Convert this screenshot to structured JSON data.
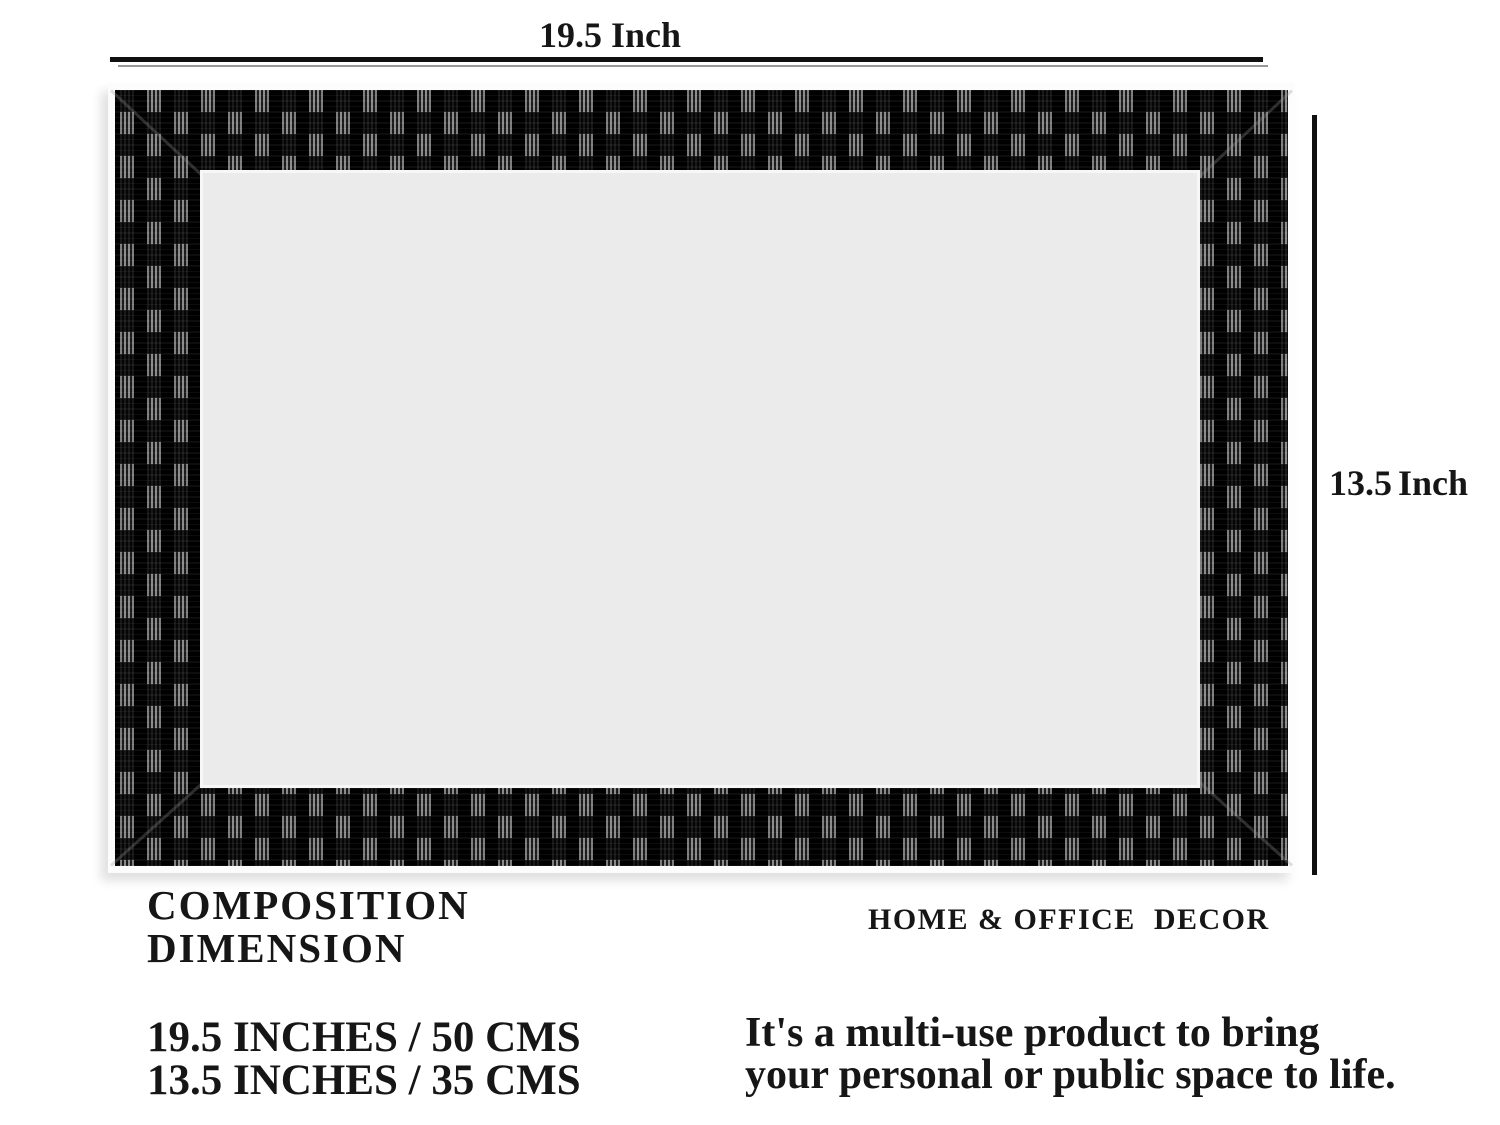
{
  "dimensions": {
    "width_label": "19.5 Inch",
    "height_label": "13.5 Inch"
  },
  "colors": {
    "background": "#ffffff",
    "frame": "#0b0b0b",
    "frame_inner_panel": "#ebebeb",
    "dimension_lines": "#101010",
    "text": "#161616"
  },
  "info": {
    "heading_line1": "COMPOSITION",
    "heading_line2": "DIMENSION",
    "brand": "HOME & OFFICE  DECOR",
    "spec_line1": "19.5 INCHES / 50 CMS",
    "spec_line2": "13.5 INCHES / 35 CMS",
    "tagline_line1": "It's a multi-use product to bring",
    "tagline_line2": "your personal or public space to life."
  }
}
